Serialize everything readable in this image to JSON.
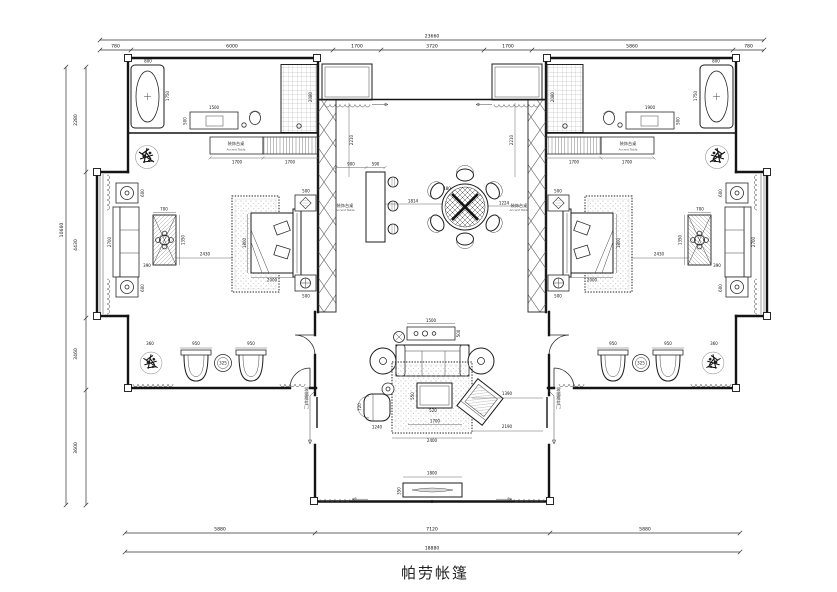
{
  "title": "帕劳帐篷",
  "labels": {
    "accent_cn": "装饰台桌",
    "accent_en": "Accent Table",
    "sliding_door": "玻璃推拉门"
  },
  "v": {
    "23660": "23660",
    "780": "780",
    "6000": "6000",
    "1700": "1700",
    "3720": "3720",
    "5860": "5860",
    "2280": "2280",
    "4430": "4430",
    "3460": "3460",
    "3600": "3600",
    "10660": "10660",
    "5880": "5880",
    "7120": "7120",
    "18880": "18880",
    "800": "800",
    "1750": "1750",
    "1500": "1500",
    "1900": "1900",
    "500": "500",
    "2080": "2080",
    "1800": "1800",
    "2000": "2000",
    "2700": "2700",
    "600": "600",
    "700": "700",
    "1350": "1350",
    "390": "390",
    "2430": "2430",
    "950": "950",
    "360": "360",
    "325": "325",
    "2210": "2210",
    "900": "900",
    "590": "590",
    "1814": "1814",
    "480": "480",
    "1224": "1224",
    "2400": "2400",
    "2190": "2190",
    "1390": "1390",
    "550": "550",
    "520": "520",
    "720": "720",
    "1240": "1240",
    "350": "350"
  }
}
